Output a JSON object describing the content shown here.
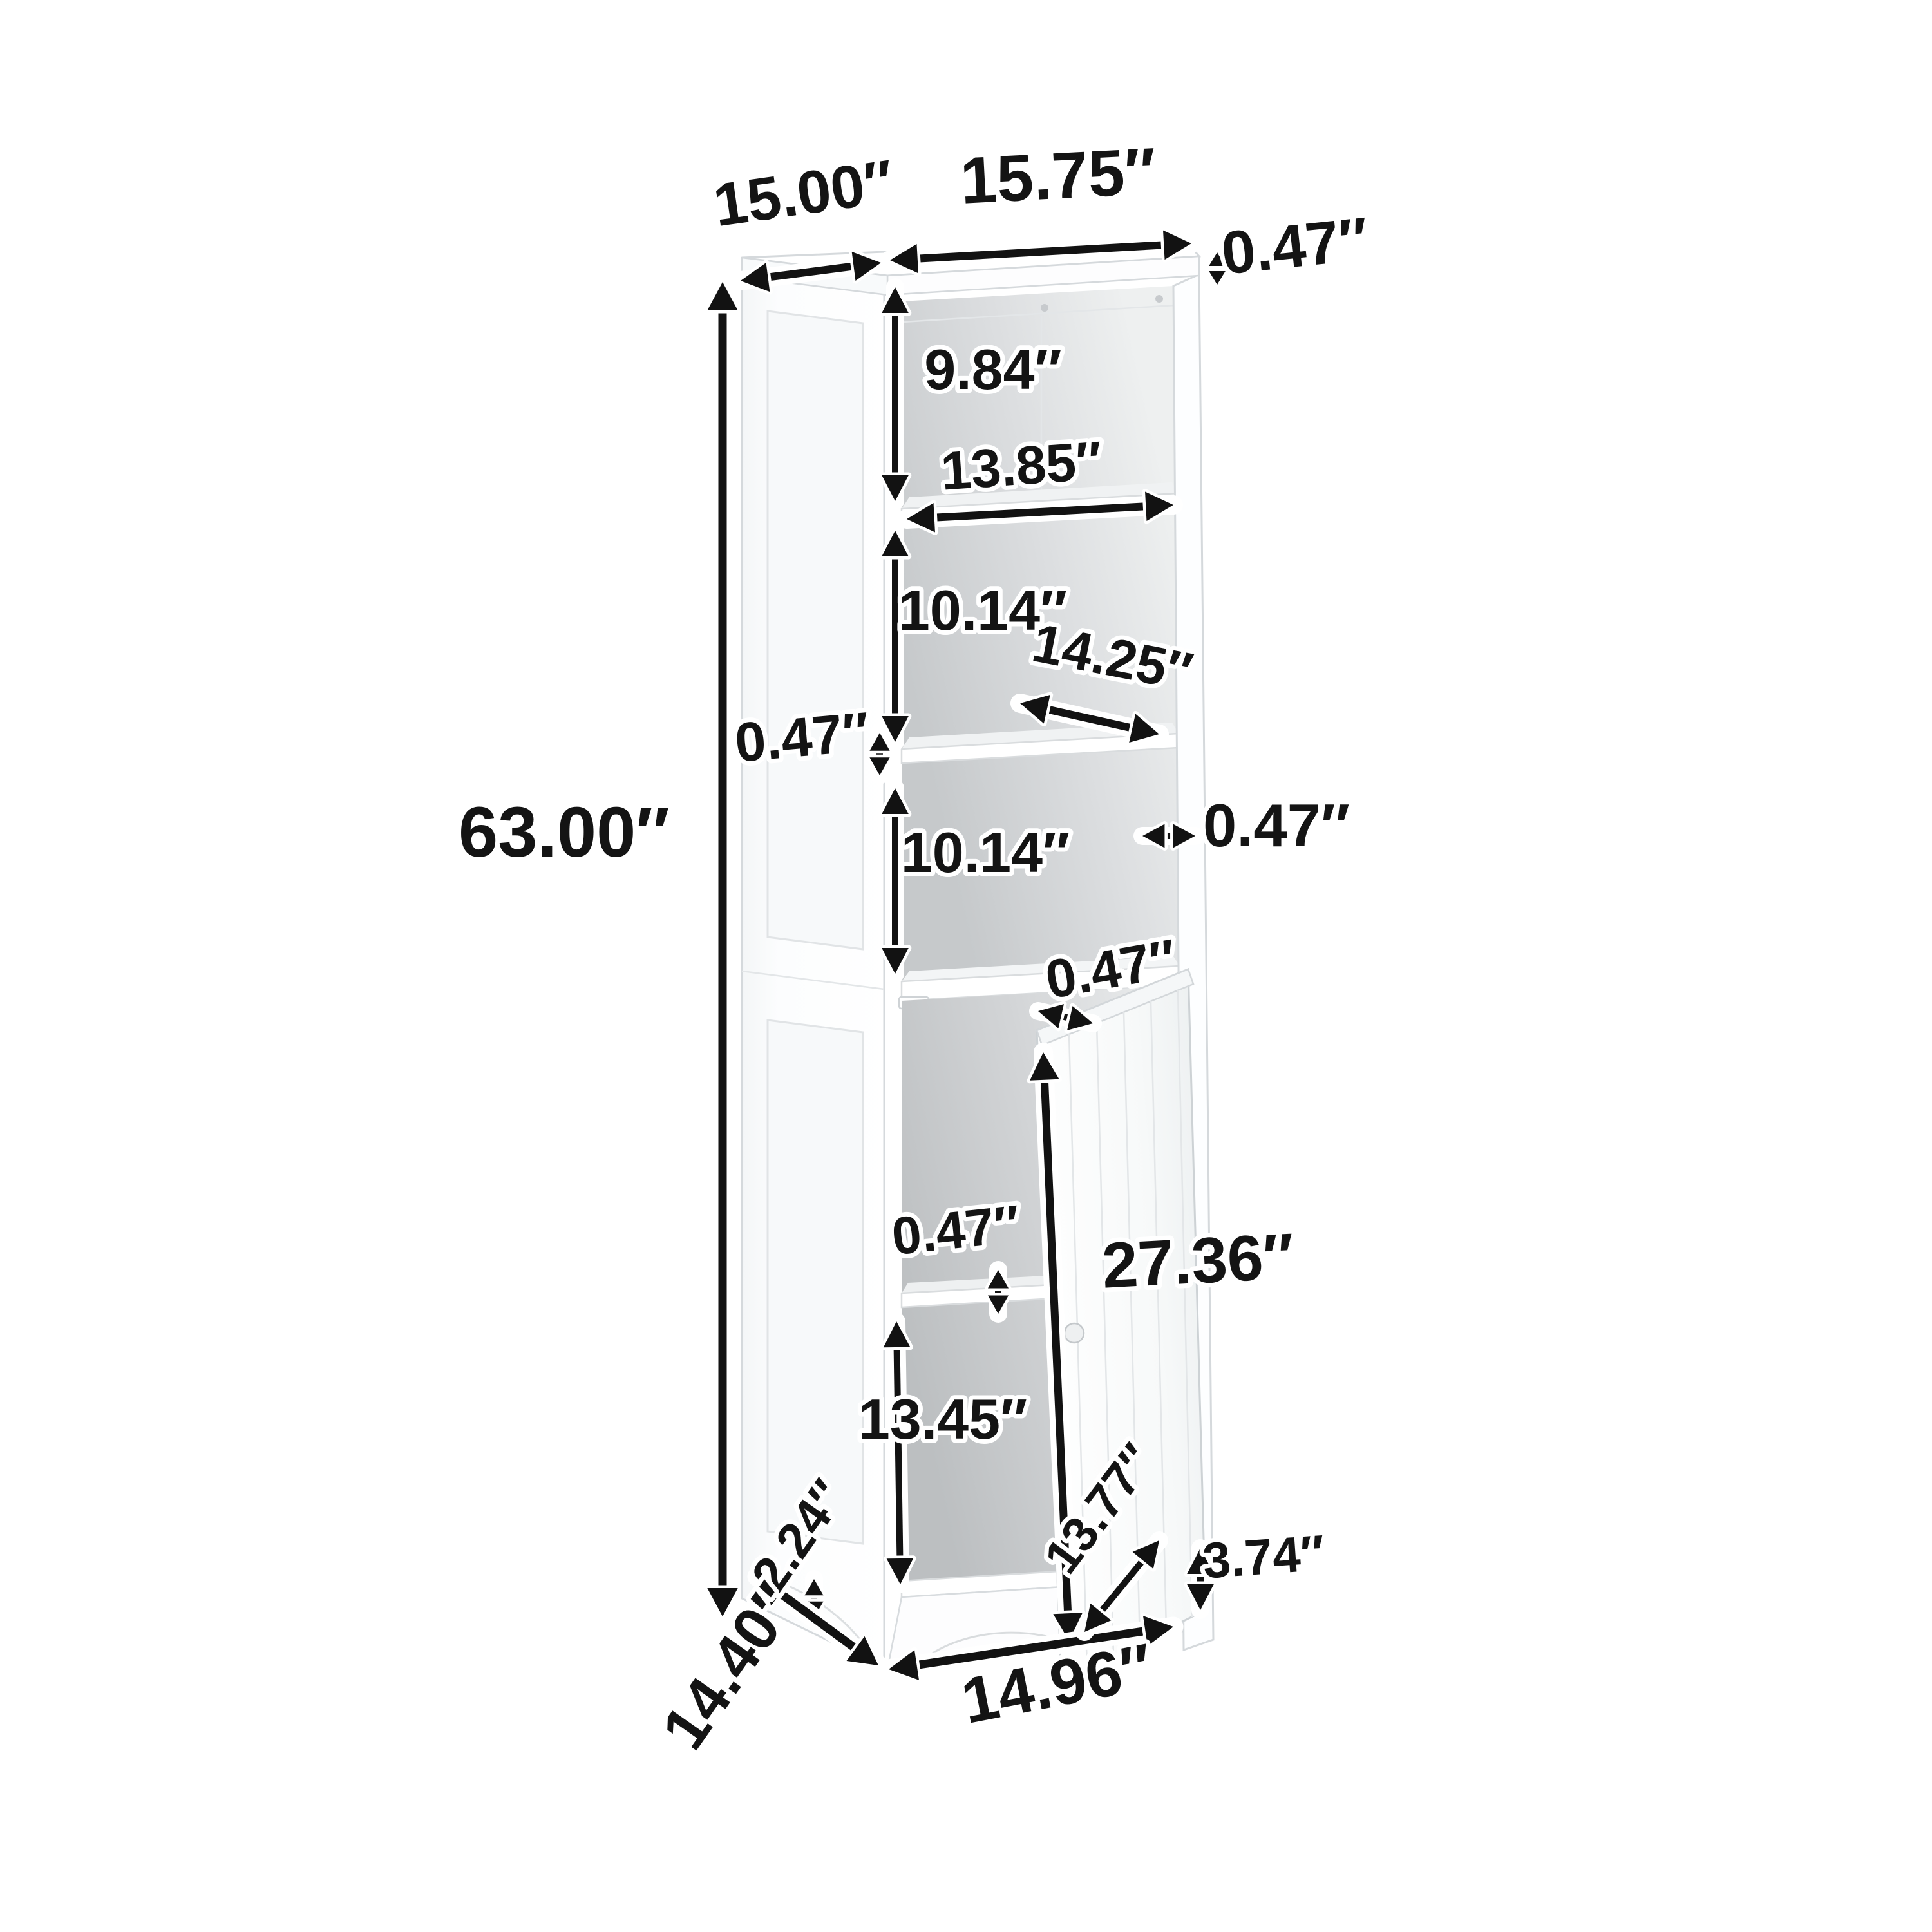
{
  "diagram": {
    "kind": "product-dimension-diagram",
    "subject": "tall narrow storage cabinet with three open shelves and lower door compartment",
    "unit": "inches",
    "background_color": "#ffffff",
    "arrow_color": "#121212",
    "halo_color": "#ffffff",
    "cabinet_color": "#fcfdfe",
    "interior_color": "#c8cbcd"
  },
  "dims": {
    "overall_height": "63.00″",
    "top_depth": "15.00″",
    "top_width": "15.75″",
    "top_thickness": "0.47″",
    "upper_cubby_height": "9.84″",
    "shelf_width": "13.85″",
    "middle_cubby_height": "10.14″",
    "shelf_depth": "14.25″",
    "shelf_thickness": "0.47″",
    "lower_open_cubby_height": "10.14″",
    "side_panel_thickness": "0.47″",
    "door_panel_thickness": "0.47″",
    "door_section_height": "27.36″",
    "cabinet_shelf_thickness": "0.47″",
    "cabinet_compartment_height": "13.45″",
    "leg_height": "2.24″",
    "base_depth": "14.40″",
    "base_width": "14.96″",
    "door_width": "13.77″",
    "base_apron_height": "3.74″"
  }
}
